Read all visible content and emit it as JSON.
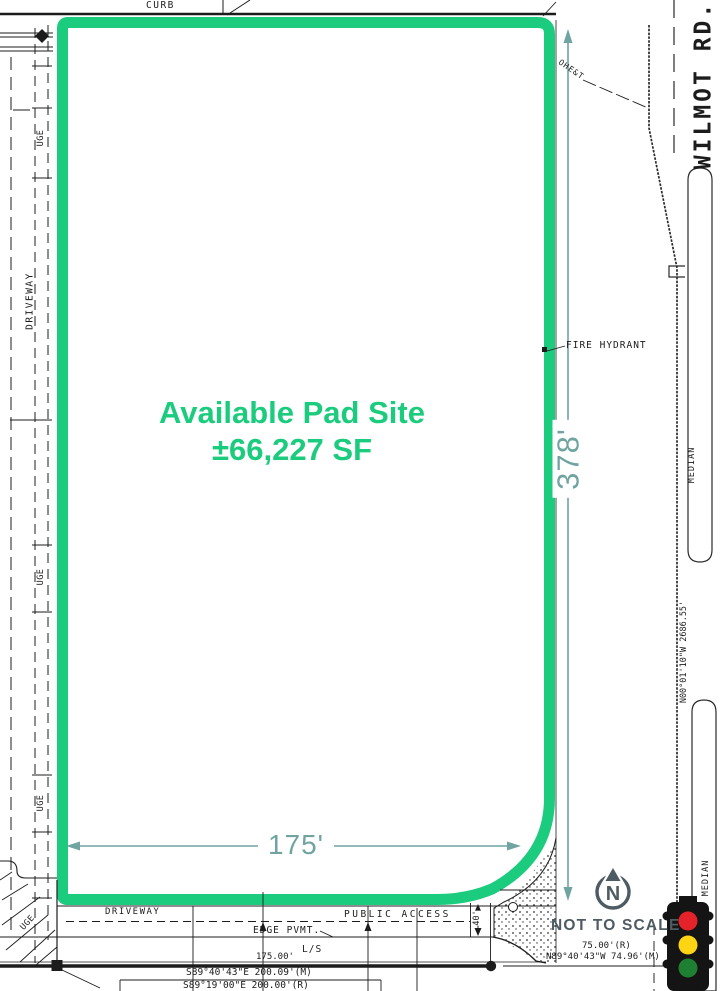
{
  "pad": {
    "line1": "Available Pad Site",
    "line2": "±66,227 SF"
  },
  "dims": {
    "height": "378'",
    "width": "175'",
    "access_width": "40'"
  },
  "street": {
    "name": "WILMOT RD.",
    "median_upper": "MEDIAN",
    "median_lower": "MEDIAN",
    "centerline_bearing": "N00°01'10\"W  2686.55'"
  },
  "labels": {
    "curb": "CURB",
    "driveway_left": "DRIVEWAY",
    "driveway_bottom": "DRIVEWAY",
    "uge_1": "UGE",
    "uge_2": "UGE",
    "uge_3": "UGE",
    "uge_4": "UGE",
    "ohet": "OHE&T",
    "fire_hydrant": "FIRE HYDRANT",
    "public_access": "PUBLIC ACCESS",
    "edge_pvmt": "EDGE PVMT.",
    "landscape": "L/S",
    "frontage": "175.00'"
  },
  "bearings": {
    "south_measured": "S89°40'43\"E  200.09'(M)",
    "south_record": "S89°19'00\"E  200.00'(R)",
    "corner_record": "75.00'(R)",
    "corner_measured": "N89°40'43\"W  74.96'(M)"
  },
  "compass": {
    "letter": "N",
    "note": "NOT TO SCALE"
  },
  "colors": {
    "pad_outline": "#1ccc7e",
    "dimension_teal": "#6fa4a0",
    "slate": "#4d5b62",
    "ink": "#1c1c1c",
    "signal_red": "#e32329",
    "signal_yellow": "#ffd412",
    "signal_green": "#1e7e31"
  }
}
